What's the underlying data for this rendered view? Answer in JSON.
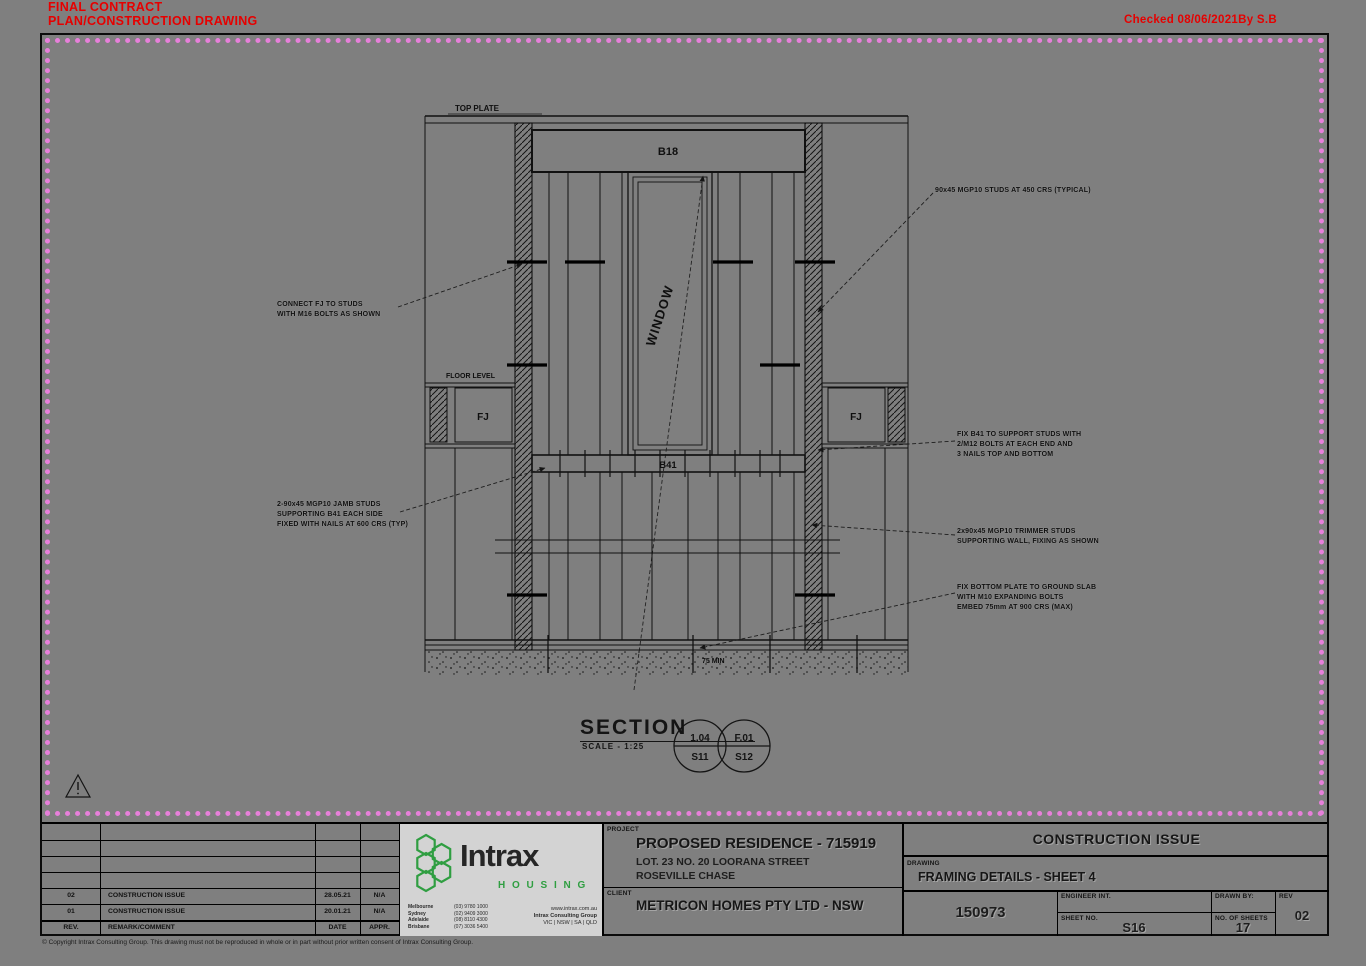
{
  "stamp": {
    "line1": "FINAL CONTRACT",
    "line2": "PLAN/CONSTRUCTION DRAWING",
    "checked": "Checked 08/06/2021By S.B"
  },
  "drawing": {
    "labels": {
      "top_plate": "TOP PLATE",
      "header_beam": "B18",
      "window": "WINDOW",
      "floor_level": "FLOOR LEVEL",
      "fj_left": "FJ",
      "fj_right": "FJ",
      "sill_beam": "B41",
      "slab_note": "75 MIN"
    },
    "annotations": {
      "a1": [
        "CONNECT FJ TO STUDS",
        "WITH M16 BOLTS AS SHOWN"
      ],
      "a2": [
        "90x45 MGP10 STUDS AT 450 CRS (TYPICAL)"
      ],
      "a3": [
        "FIX B41 TO SUPPORT STUDS WITH",
        "2/M12 BOLTS AT EACH END AND",
        "3 NAILS TOP AND BOTTOM"
      ],
      "a4": [
        "2-90x45 MGP10 JAMB STUDS",
        "SUPPORTING B41 EACH SIDE",
        "FIXED WITH NAILS AT 600 CRS (TYP)"
      ],
      "a5": [
        "2x90x45 MGP10 TRIMMER STUDS",
        "SUPPORTING WALL, FIXING AS SHOWN"
      ],
      "a6": [
        "FIX BOTTOM PLATE TO GROUND SLAB",
        "WITH M10 EXPANDING BOLTS",
        "EMBED 75mm AT 900 CRS (MAX)"
      ]
    },
    "section": {
      "title": "SECTION",
      "scale": "SCALE - 1:25",
      "bubble1_top": "1.04",
      "bubble1_bottom": "S11",
      "bubble2_top": "F.01",
      "bubble2_bottom": "S12"
    }
  },
  "title_block": {
    "revisions": {
      "headers": {
        "rev": "REV.",
        "remark": "REMARK/COMMENT",
        "date": "DATE",
        "appr": "APPR."
      },
      "rows": [
        {
          "rev": "02",
          "remark": "CONSTRUCTION ISSUE",
          "date": "28.05.21",
          "appr": "N/A"
        },
        {
          "rev": "01",
          "remark": "CONSTRUCTION ISSUE",
          "date": "20.01.21",
          "appr": "N/A"
        }
      ]
    },
    "logo": {
      "name": "Intrax",
      "division": "H O U S I N G",
      "offices": [
        "Melbourne",
        "Sydney",
        "Adelaide",
        "Brisbane"
      ],
      "phones": [
        "(03) 9780 1000",
        "(02) 9409 3000",
        "(08) 8110 4300",
        "(07) 3036 5400"
      ],
      "site": "www.intrax.com.au",
      "group": "Intrax Consulting Group",
      "states": "VIC | NSW | SA | QLD",
      "green": "#2f9e41"
    },
    "project": {
      "label": "PROJECT",
      "name": "PROPOSED RESIDENCE - 715919",
      "address1": "LOT. 23 NO. 20 LOORANA STREET",
      "address2": "ROSEVILLE CHASE"
    },
    "client": {
      "label": "CLIENT",
      "name": "METRICON HOMES PTY LTD - NSW"
    },
    "issue": {
      "header": "CONSTRUCTION ISSUE",
      "drawing_label": "DRAWING",
      "drawing_name": "FRAMING DETAILS - SHEET 4",
      "job_no": "150973",
      "engineer_label": "ENGINEER INT.",
      "sheet_label": "SHEET NO.",
      "sheet_no": "S16",
      "drawn_label": "DRAWN BY:",
      "sheets_label": "NO. OF SHEETS",
      "sheets": "17",
      "rev_label": "REV",
      "rev": "02"
    },
    "copyright": "© Copyright Intrax Consulting Group. This drawing must not be reproduced in whole or in part without prior written consent of Intrax Consulting Group."
  }
}
